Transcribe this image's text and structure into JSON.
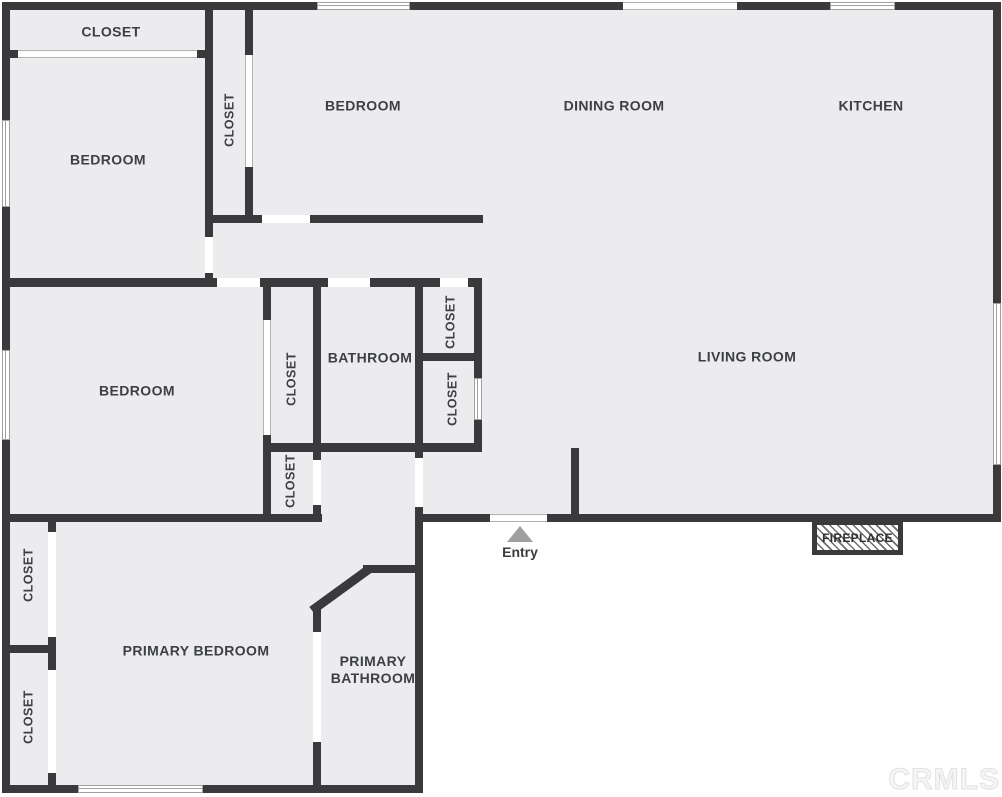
{
  "title": "Floor plan",
  "watermark": "CRMLS",
  "entry": {
    "label": "Entry"
  },
  "fireplace": {
    "label": "FIREPLACE"
  },
  "colors": {
    "wall": "#3a3a3c",
    "floor": "#ececee",
    "background": "#ffffff",
    "label": "#3d4043",
    "entry_arrow": "#a0a0a2",
    "window_line": "#a0a0a0",
    "watermark_outline": "#e2e2e2"
  },
  "labels": [
    {
      "id": "closet-top-left",
      "text": "CLOSET",
      "x": 111,
      "y": 32,
      "vertical": false
    },
    {
      "id": "bedroom-top-left",
      "text": "BEDROOM",
      "x": 108,
      "y": 160,
      "vertical": false
    },
    {
      "id": "closet-tall",
      "text": "CLOSET",
      "x": 230,
      "y": 120,
      "vertical": true
    },
    {
      "id": "bedroom-top-middle",
      "text": "BEDROOM",
      "x": 363,
      "y": 106,
      "vertical": false
    },
    {
      "id": "dining-room",
      "text": "DINING ROOM",
      "x": 614,
      "y": 106,
      "vertical": false
    },
    {
      "id": "kitchen",
      "text": "KITCHEN",
      "x": 871,
      "y": 106,
      "vertical": false
    },
    {
      "id": "bedroom-middle-left",
      "text": "BEDROOM",
      "x": 137,
      "y": 391,
      "vertical": false
    },
    {
      "id": "closet-bedroom",
      "text": "CLOSET",
      "x": 292,
      "y": 379,
      "vertical": true
    },
    {
      "id": "bathroom",
      "text": "BATHROOM",
      "x": 370,
      "y": 358,
      "vertical": false
    },
    {
      "id": "closet-hall-upper",
      "text": "CLOSET",
      "x": 451,
      "y": 322,
      "vertical": true
    },
    {
      "id": "closet-hall-lower",
      "text": "CLOSET",
      "x": 453,
      "y": 399,
      "vertical": true
    },
    {
      "id": "closet-below-bathroom",
      "text": "CLOSET",
      "x": 291,
      "y": 481,
      "vertical": true
    },
    {
      "id": "living-room",
      "text": "LIVING ROOM",
      "x": 747,
      "y": 357,
      "vertical": false
    },
    {
      "id": "closet-bottom-left-1",
      "text": "CLOSET",
      "x": 29,
      "y": 575,
      "vertical": true
    },
    {
      "id": "closet-bottom-left-2",
      "text": "CLOSET",
      "x": 29,
      "y": 717,
      "vertical": true
    },
    {
      "id": "primary-bedroom",
      "text": "PRIMARY BEDROOM",
      "x": 196,
      "y": 651,
      "vertical": false
    },
    {
      "id": "primary-bathroom",
      "text": "PRIMARY\nBATHROOM",
      "x": 373,
      "y": 670,
      "vertical": false
    }
  ]
}
